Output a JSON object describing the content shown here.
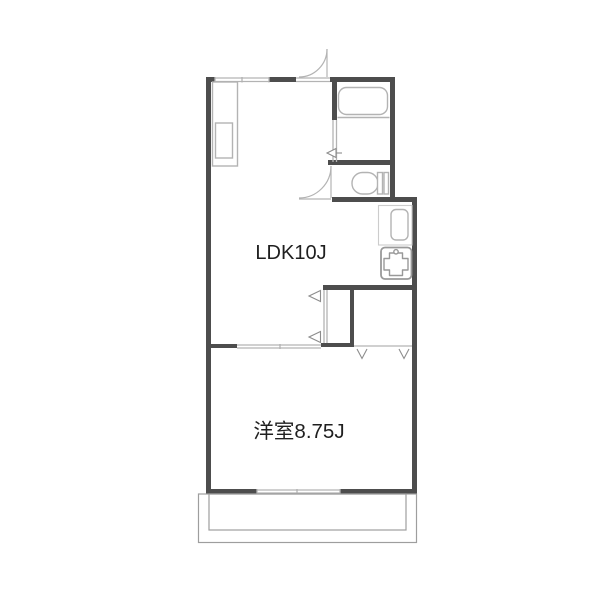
{
  "floorplan": {
    "labels": {
      "ldk": "LDK10J",
      "bedroom": "洋室8.75J"
    },
    "colors": {
      "wall": "#4d4d4d",
      "opening": "#b3b3b3",
      "fixture": "#b3b3b3",
      "fixture_light": "#cccccc",
      "fixture_strong": "#999999",
      "marker": "#8c8c8c",
      "text": "#1f1f1f",
      "background": "#ffffff"
    },
    "fixtures": [
      "entrance-door",
      "top-window",
      "storage-cabinet",
      "bathtub",
      "washroom-door",
      "toilet",
      "toilet-door",
      "water-heater",
      "kitchen-sink",
      "closet",
      "closet-door",
      "sliding-door",
      "bottom-window",
      "balcony"
    ]
  }
}
